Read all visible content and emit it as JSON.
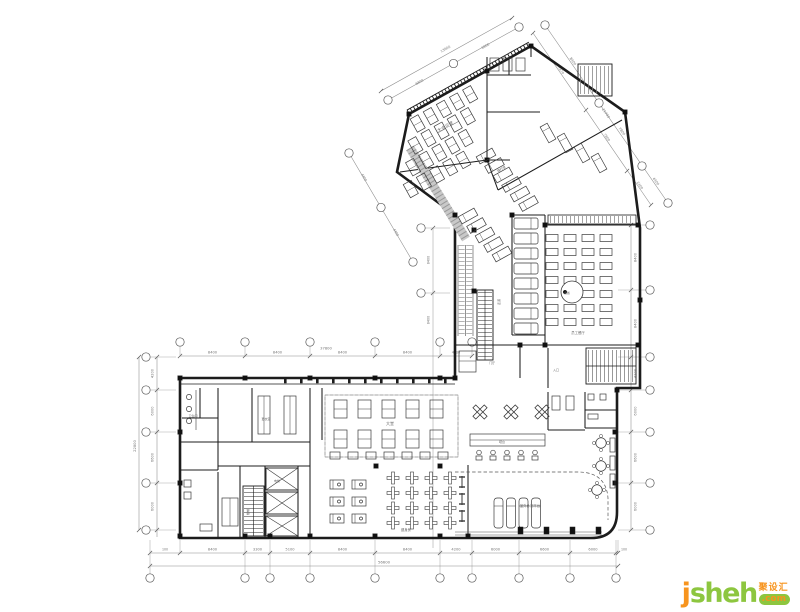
{
  "page": {
    "background": "#ffffff"
  },
  "colors": {
    "wall": "#1c1c1c",
    "furniture": "#3a3a3a",
    "dimension": "#8a8a8a",
    "dim_text": "#777777",
    "label_text": "#666666",
    "escalator": "#9a9a9a",
    "logo_orange": "#f7941e",
    "logo_green": "#8dc63f"
  },
  "drawing": {
    "type": "architectural-floor-plan",
    "dims": {
      "bottom": {
        "edge": [
          "100",
          "100"
        ],
        "segments": [
          "8400",
          "3300",
          "5100",
          "8400",
          "8400",
          "4200",
          "6000",
          "6600",
          "6000"
        ],
        "total": "56600"
      },
      "top": {
        "segments": [
          "8400",
          "8400",
          "8400",
          "8400",
          "4200"
        ],
        "total": "37800"
      },
      "left": {
        "segments": [
          "4200",
          "6000",
          "6600",
          "6000"
        ],
        "total": "22800"
      },
      "right": {
        "segments": [
          "8400",
          "8400",
          "4200",
          "6000",
          "6600",
          "6000"
        ]
      },
      "wing_ne_outer": {
        "segments": [
          "8400",
          "7800",
          "4400"
        ],
        "total": "21700"
      },
      "wing_ne_inner": {
        "segments": [
          "7470",
          "7800",
          "2400"
        ]
      },
      "wing_nw": {
        "segments": [
          "6800",
          "6800"
        ],
        "total": "13600"
      },
      "mid_diag": {
        "segments": [
          "4400",
          "4400"
        ]
      },
      "stem_left": {
        "segments": [
          "8400",
          "8400"
        ]
      }
    },
    "rooms": [
      "大会议室",
      "理疗室",
      "员工餐厅",
      "备餐",
      "大堂",
      "健身房",
      "室外休闲平台",
      "楼梯",
      "电梯",
      "卫生间",
      "更衣室",
      "门厅",
      "吧台",
      "走道",
      "入口"
    ]
  },
  "logo": {
    "brand_j": "j",
    "brand_rest": "sheh",
    "cn": "聚设汇",
    "tld": ".com"
  }
}
